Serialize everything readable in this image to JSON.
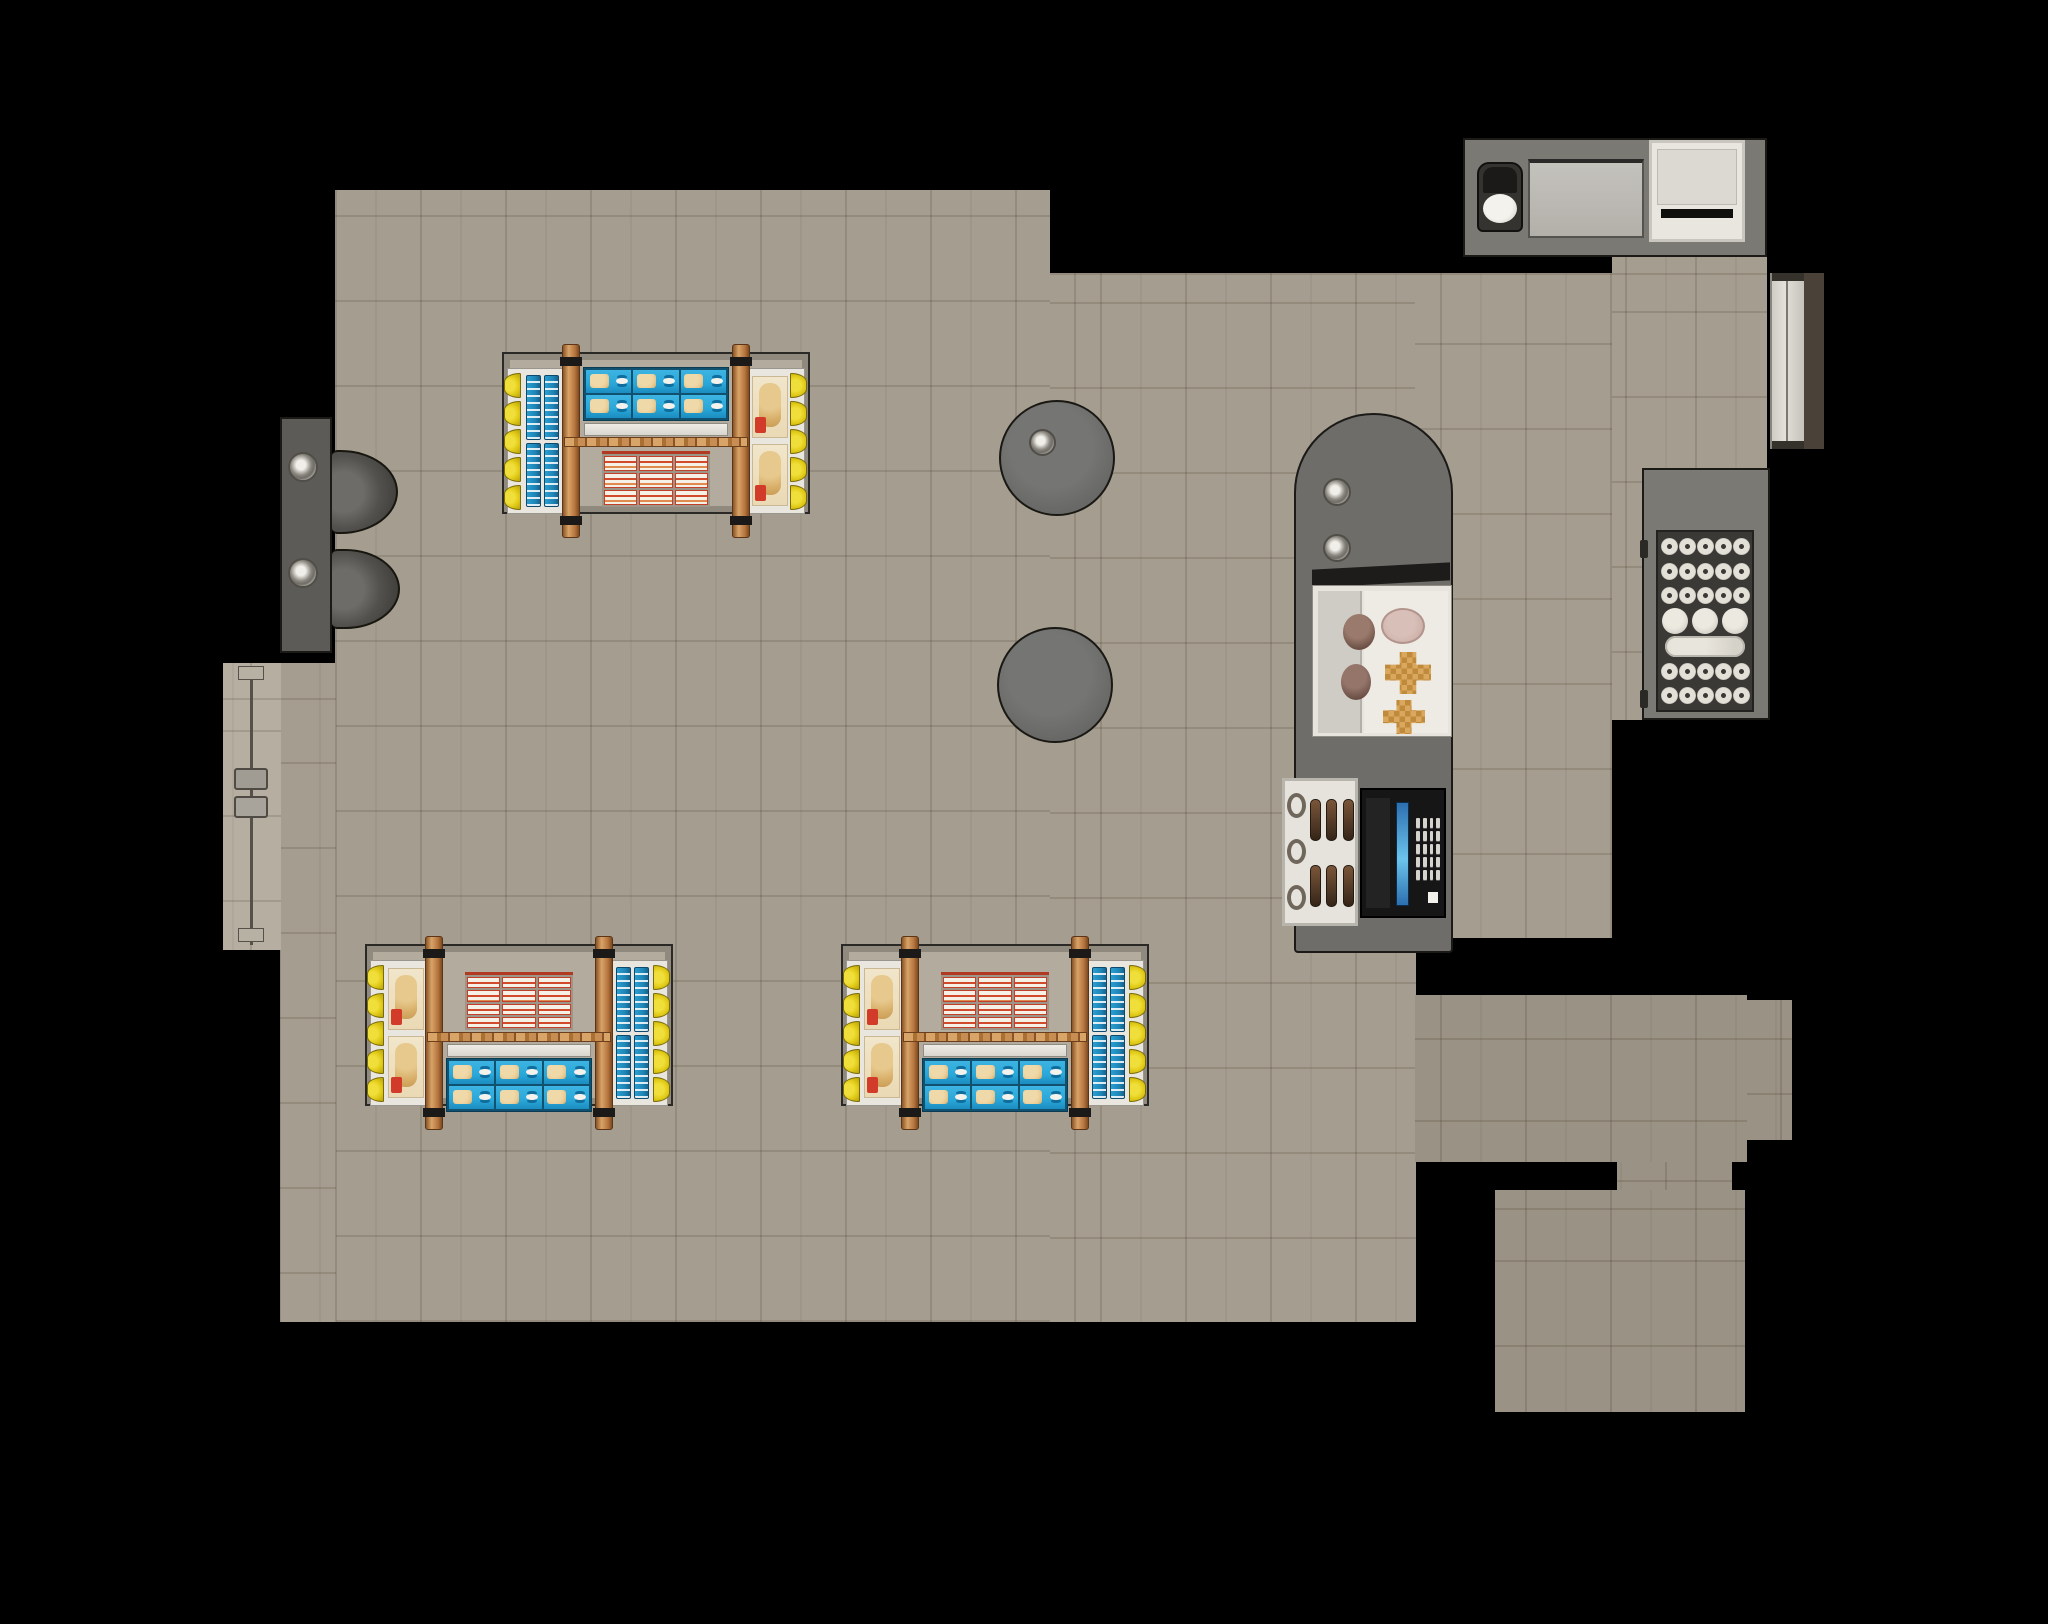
{
  "scene": {
    "kind": "top-down-3d-floorplan-render",
    "canvas": {
      "width": 2048,
      "height": 1624
    }
  },
  "palette": {
    "bg": "#000000",
    "floor_main": "#a59d8f",
    "floor_room": "#9a9284",
    "floor_vest": "#b6afa1",
    "counter": "#6e6d69",
    "counter_left": "#5c5b57",
    "platform": "#b2ab9e",
    "tray": "#e9e6df",
    "yellow": "#e2cb18",
    "red": "#d23b2a",
    "blue_box": "#2aa7d8",
    "blue_pack": "#1f86b8",
    "wood_light": "#d8a468",
    "wood_dark": "#8a5426",
    "donut_cream": "#dcd9d1",
    "dark_tray": "#3b3936",
    "register_black": "#161616",
    "screen_blue": "#6cc4ec",
    "case_white": "#e7e4dd",
    "pink_pastry": "#cdb2aa",
    "cruller_tan": "#d9a85e"
  },
  "fixtures": {
    "entry_door_left": {
      "label": "entry-door-vestibule",
      "panels": 1
    },
    "service_counter_left": {
      "label": "barista-counter",
      "metal_discs": 2,
      "bins": 2
    },
    "prep_counter_top_right": {
      "label": "prep-counter",
      "items": [
        "coffee-machine",
        "griddle-panel",
        "supply-box"
      ]
    },
    "side_door_right": {
      "label": "side-door",
      "panels": 2
    },
    "cafe_tables": [
      {
        "label": "round-cafe-table",
        "napkin_disc": true
      },
      {
        "label": "round-cafe-table",
        "napkin_disc": false
      }
    ],
    "display_tables": [
      {
        "label": "gondola-top",
        "variant": "flip",
        "left_tray": "blue-packs",
        "right_tray": "bread"
      },
      {
        "label": "gondola-bottom-left",
        "variant": "norm",
        "left_tray": "bread",
        "right_tray": "blue-packs"
      },
      {
        "label": "gondola-bottom-right",
        "variant": "norm",
        "left_tray": "bread",
        "right_tray": "blue-packs"
      }
    ],
    "products": {
      "blue_box_grid": {
        "cols": 3,
        "rows": 2
      },
      "red_box_grid_flip": {
        "cols": 3,
        "rows": 3
      },
      "red_box_grid_norm": {
        "cols": 3,
        "rows": 4
      },
      "blue_pack_group": {
        "cols": 2,
        "rows": 2
      },
      "bread_group": {
        "count": 2
      },
      "scallops_per_column": 5
    },
    "donut_case": {
      "label": "donut-display-cabinet",
      "rows": [
        {
          "kind": "small",
          "count": 5
        },
        {
          "kind": "small",
          "count": 5
        },
        {
          "kind": "small",
          "count": 5
        },
        {
          "kind": "large",
          "count": 3
        },
        {
          "kind": "loaf",
          "count": 1
        },
        {
          "kind": "small",
          "count": 5
        },
        {
          "kind": "small",
          "count": 5
        }
      ]
    },
    "checkout": {
      "label": "checkout-counter",
      "metal_discs": 2,
      "display_case": {
        "brown_donuts": 2,
        "pink_oval": 1,
        "crullers": 2
      },
      "pastry_tray": {
        "rings": 3,
        "eclair_rows": 2,
        "eclair_cols": 3
      },
      "register": {
        "keypad_rows": 5,
        "keypad_cols": 4,
        "screen": true,
        "chip": true
      }
    }
  }
}
